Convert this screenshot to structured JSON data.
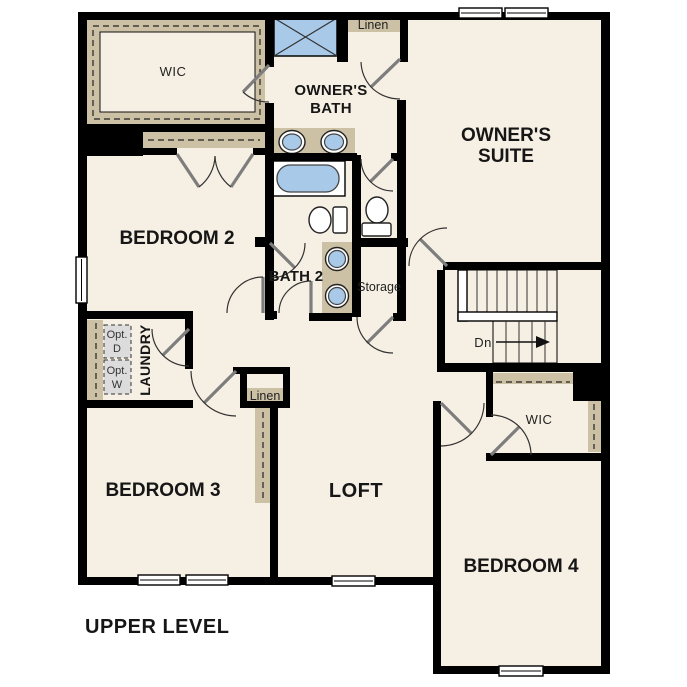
{
  "colors": {
    "background": "#ffffff",
    "room_fill": "#f6efe3",
    "closet_fill": "#cdc1a5",
    "fixture_blue": "#a9c9e9",
    "wall_black": "#000000",
    "optional_appliance_fill": "#dcdcdc",
    "door_leaf_gray": "#7d7d7d"
  },
  "labels": {
    "wic_owner": "WIC",
    "linen_top": "Linen",
    "owners_bath_line1": "OWNER'S",
    "owners_bath_line2": "BATH",
    "owners_suite_line1": "OWNER'S",
    "owners_suite_line2": "SUITE",
    "bedroom2": "BEDROOM 2",
    "bath2": "BATH 2",
    "storage": "Storage",
    "stairs_down": "Dn",
    "laundry": "LAUNDRY",
    "opt_dryer_line1": "Opt.",
    "opt_dryer_line2": "D",
    "opt_washer_line1": "Opt.",
    "opt_washer_line2": "W",
    "linen_hall": "Linen",
    "bedroom3": "BEDROOM 3",
    "loft": "LOFT",
    "wic_bedroom4": "WIC",
    "bedroom4": "BEDROOM 4",
    "level_title": "UPPER LEVEL"
  }
}
